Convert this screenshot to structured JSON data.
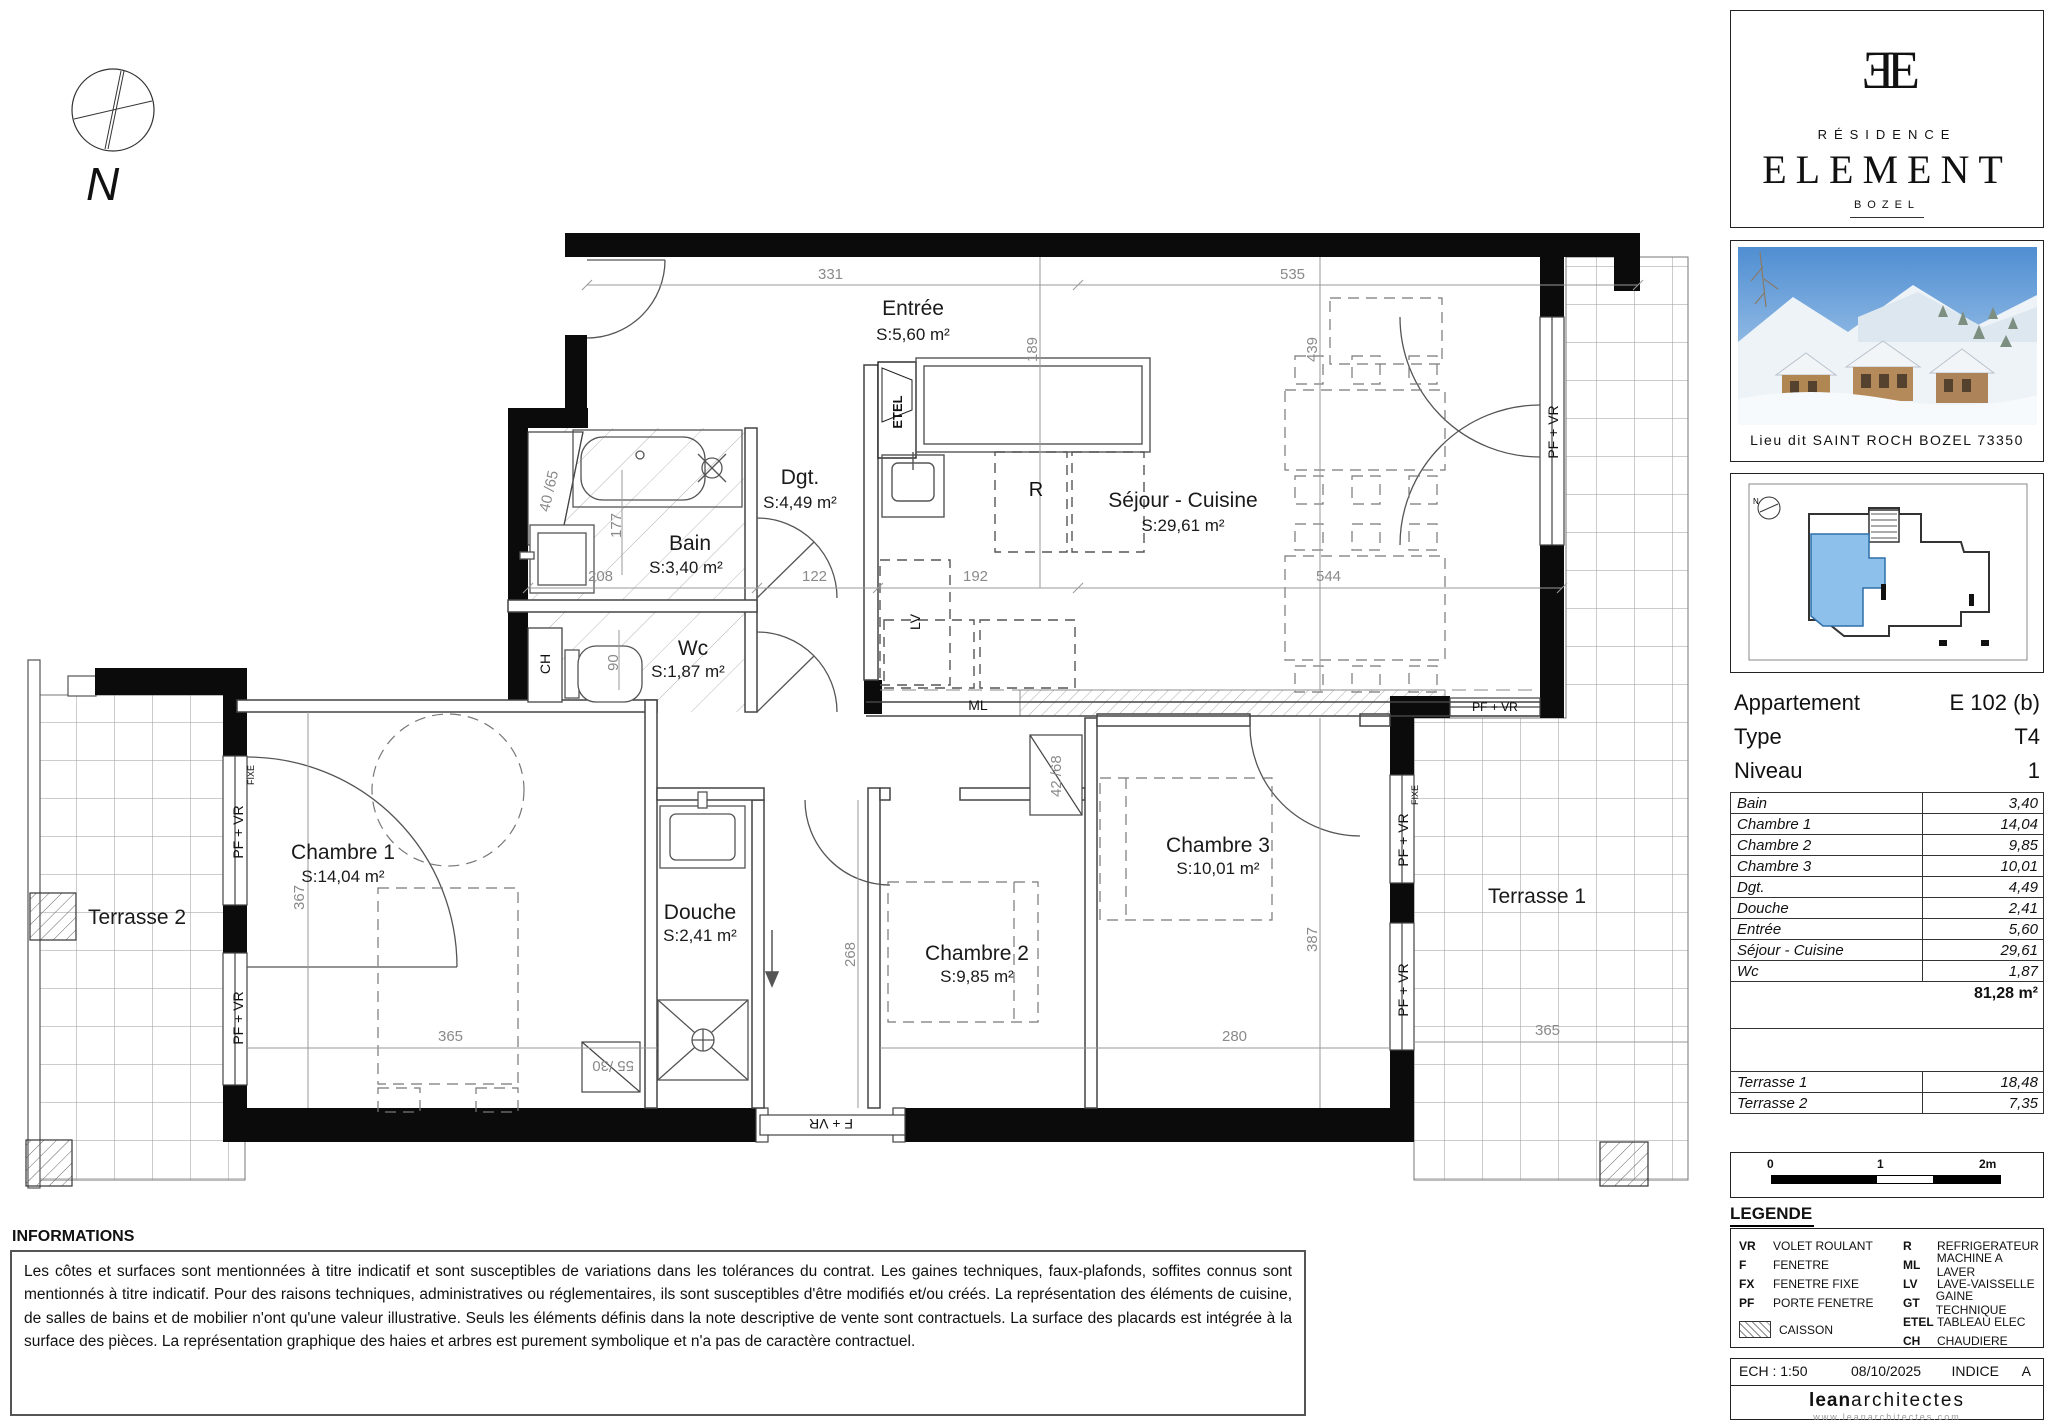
{
  "plan": {
    "rooms": {
      "entree": {
        "name": "Entrée",
        "area": "S:5,60 m²"
      },
      "dgt": {
        "name": "Dgt.",
        "area": "S:4,49 m²"
      },
      "bain": {
        "name": "Bain",
        "area": "S:3,40 m²"
      },
      "wc": {
        "name": "Wc",
        "area": "S:1,87 m²"
      },
      "sejour": {
        "name": "Séjour - Cuisine",
        "area": "S:29,61 m²"
      },
      "ch1": {
        "name": "Chambre 1",
        "area": "S:14,04 m²"
      },
      "douche": {
        "name": "Douche",
        "area": "S:2,41 m²"
      },
      "ch2": {
        "name": "Chambre 2",
        "area": "S:9,85 m²"
      },
      "ch3": {
        "name": "Chambre 3",
        "area": "S:10,01 m²"
      },
      "t1": {
        "name": "Terrasse 1"
      },
      "t2": {
        "name": "Terrasse 2"
      }
    },
    "dims": {
      "a331": "331",
      "a535": "535",
      "v189": "189",
      "v439": "439",
      "a208": "208",
      "a122": "122",
      "a192": "192",
      "a544": "544",
      "v177": "177",
      "v90": "90",
      "w4065": "40 /65",
      "w5530": "55 /30",
      "w4268": "42 /68",
      "v367": "367",
      "a365": "365",
      "a268": "268",
      "a280": "280",
      "v387": "387",
      "t365": "365"
    },
    "labels": {
      "pf_vr": "PF + VR",
      "f_vr": "F + VR",
      "fixe": "FIXE",
      "etel": "ETEL",
      "r": "R",
      "lv": "LV",
      "ml": "ML",
      "ch": "CH",
      "n": "N"
    }
  },
  "sidebar": {
    "logo": {
      "monogram": "ƎE",
      "residence": "RÉSIDENCE",
      "name": "ELEMENT",
      "city": "BOZEL"
    },
    "photo_caption": "Lieu dit SAINT ROCH BOZEL 73350",
    "apartment": {
      "label": "Appartement",
      "value": "E 102 (b)",
      "type_label": "Type",
      "type": "T4",
      "level_label": "Niveau",
      "level": "1"
    },
    "areas": {
      "rows": [
        [
          "Bain",
          "3,40"
        ],
        [
          "Chambre 1",
          "14,04"
        ],
        [
          "Chambre 2",
          "9,85"
        ],
        [
          "Chambre 3",
          "10,01"
        ],
        [
          "Dgt.",
          "4,49"
        ],
        [
          "Douche",
          "2,41"
        ],
        [
          "Entrée",
          "5,60"
        ],
        [
          "Séjour - Cuisine",
          "29,61"
        ],
        [
          "Wc",
          "1,87"
        ]
      ],
      "total": "81,28 m²",
      "terraces": [
        [
          "Terrasse 1",
          "18,48"
        ],
        [
          "Terrasse 2",
          "7,35"
        ]
      ]
    },
    "scalebar": {
      "t0": "0",
      "t1": "1",
      "t2": "2m"
    },
    "legend": {
      "title": "LEGENDE",
      "left": [
        [
          "VR",
          "VOLET ROULANT"
        ],
        [
          "F",
          "FENETRE"
        ],
        [
          "FX",
          "FENETRE FIXE"
        ],
        [
          "PF",
          "PORTE FENETRE"
        ]
      ],
      "right": [
        [
          "R",
          "REFRIGERATEUR"
        ],
        [
          "ML",
          "MACHINE A LAVER"
        ],
        [
          "LV",
          "LAVE-VAISSELLE"
        ],
        [
          "GT",
          "GAINE TECHNIQUE"
        ],
        [
          "ETEL",
          "TABLEAU ELEC"
        ],
        [
          "CH",
          "CHAUDIERE"
        ]
      ],
      "caisson": "CAISSON"
    },
    "titleblock": {
      "ech": "ECH : 1:50",
      "date": "08/10/2025",
      "indice_label": "INDICE",
      "indice": "A",
      "firm_bold": "lean",
      "firm_rest": "architectes",
      "website": "www.leanarchitectes.com"
    }
  },
  "informations": {
    "title": "INFORMATIONS",
    "body": "Les côtes et surfaces sont mentionnées à titre indicatif et sont susceptibles de variations dans les tolérances du contrat. Les gaines techniques, faux-plafonds, soffites connus sont mentionnés à titre indicatif. Pour des raisons techniques, administratives ou réglementaires, ils sont susceptibles d'être modifiés et/ou créés. La représentation des éléments de cuisine, de salles de bains et de mobilier n'ont qu'une valeur illustrative. Seuls les éléments définis dans la note descriptive de vente sont contractuels. La surface des placards est intégrée à la surface des pièces. La représentation graphique des haies et arbres est purement symbolique et n'a pas de caractère contractuel."
  }
}
